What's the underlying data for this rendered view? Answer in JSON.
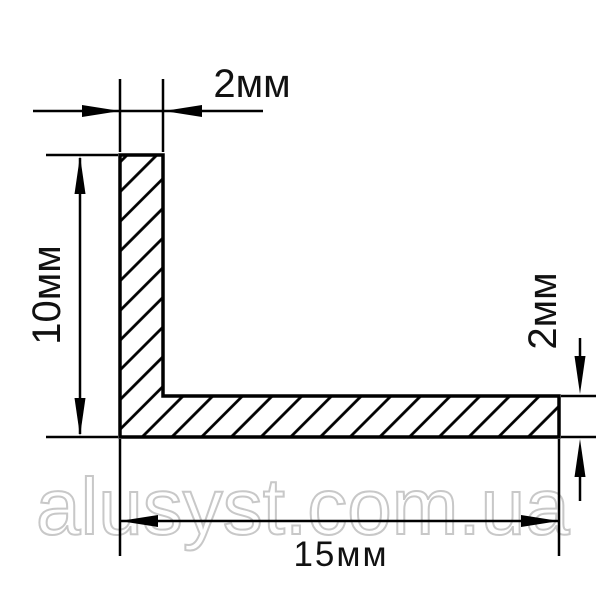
{
  "drawing": {
    "kind": "aluminum angle profile cross-section",
    "background_color": "#ffffff",
    "line_color": "#000000",
    "watermark_color": "#c8c8c8"
  },
  "dimensions": {
    "top_thickness": "2мм",
    "left_height": "10мм",
    "right_thickness": "2мм",
    "bottom_width": "15мм"
  },
  "values_mm": {
    "wall_thickness": 2,
    "height": 10,
    "width": 15
  },
  "watermark": {
    "text": "alusyst.com.ua"
  }
}
